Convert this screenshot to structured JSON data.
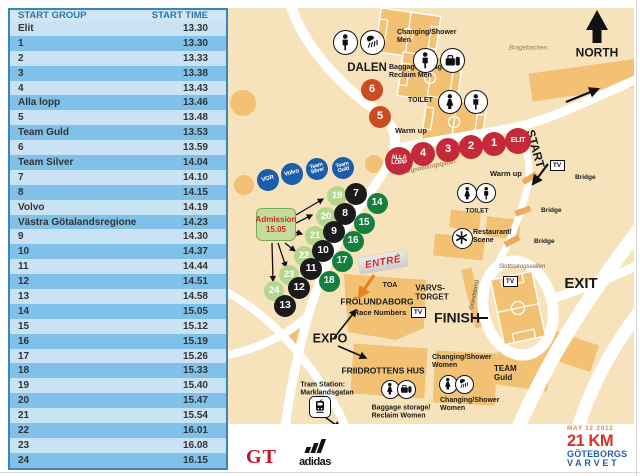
{
  "colors": {
    "map_bg": "#f7e3bb",
    "building": "#f2c173",
    "road": "#ffffff",
    "red": "#c42a3a",
    "orangered": "#cc4b20",
    "blue": "#1a5da8",
    "black_badge": "#1b1b1b",
    "dark_green": "#15803d",
    "light_green": "#b5d78d",
    "table_border": "#3a86bb",
    "row_light": "#c9e3f4",
    "row_dark": "#7fc1e8",
    "header_bg": "#d2e6f3",
    "header_text": "#2d76ab",
    "cell_text": "#333333",
    "admission_bg": "#c3dc9b",
    "admission_border": "#76ab53",
    "admission_text": "#d22b2b",
    "entre_text": "#d42b2b",
    "street_text": "#8a6a40",
    "logo_date": "#d98a3f",
    "logo_distance": "#d63226",
    "logo_name": "#2160a8",
    "gt_red": "#cc1126"
  },
  "table": {
    "headers": [
      "START GROUP",
      "START TIME"
    ],
    "rows": [
      [
        "Elit",
        "13.30"
      ],
      [
        "1",
        "13.30"
      ],
      [
        "2",
        "13.33"
      ],
      [
        "3",
        "13.38"
      ],
      [
        "4",
        "13.43"
      ],
      [
        "Alla lopp",
        "13.46"
      ],
      [
        "5",
        "13.48"
      ],
      [
        "Team Guld",
        "13.53"
      ],
      [
        "6",
        "13.59"
      ],
      [
        "Team Silver",
        "14.04"
      ],
      [
        "7",
        "14.10"
      ],
      [
        "8",
        "14.15"
      ],
      [
        "Volvo",
        "14.19"
      ],
      [
        "Västra Götalandsregionen",
        "14.23"
      ],
      [
        "9",
        "14.30"
      ],
      [
        "10",
        "14.37"
      ],
      [
        "11",
        "14.44"
      ],
      [
        "12",
        "14.51"
      ],
      [
        "13",
        "14.58"
      ],
      [
        "14",
        "15.05"
      ],
      [
        "15",
        "15.12"
      ],
      [
        "16",
        "15.19"
      ],
      [
        "17",
        "15.26"
      ],
      [
        "18",
        "15.33"
      ],
      [
        "19",
        "15.40"
      ],
      [
        "20",
        "15.47"
      ],
      [
        "21",
        "15.54"
      ],
      [
        "22",
        "16.01"
      ],
      [
        "23",
        "16.08"
      ],
      [
        "24",
        "16.15"
      ]
    ]
  },
  "map": {
    "tv_label": "TV",
    "entre": {
      "text": "ENTRÉ"
    },
    "admission": {
      "line1": "Admission",
      "line2": "15.05"
    },
    "labels": [
      {
        "name": "label-changing-shower-men",
        "text": "Changing/Shower\nMen",
        "x": 169,
        "y": 21,
        "size": 7,
        "align": "l"
      },
      {
        "name": "label-dalen",
        "text": "DALEN",
        "x": 139,
        "y": 60,
        "size": 11.5,
        "align": "c"
      },
      {
        "name": "label-baggage-men",
        "text": "Baggage storage/\nReclaim  Men",
        "x": 161,
        "y": 56,
        "size": 7,
        "align": "l"
      },
      {
        "name": "label-toilet-top",
        "text": "TOILET",
        "x": 180,
        "y": 89,
        "size": 7,
        "align": "l"
      },
      {
        "name": "label-warm-up-1",
        "text": "Warm up",
        "x": 167,
        "y": 119,
        "size": 7.5,
        "align": "l"
      },
      {
        "name": "label-warm-up-2",
        "text": "Warm up",
        "x": 262,
        "y": 162,
        "size": 7.5,
        "align": "l"
      },
      {
        "name": "label-bragebacken",
        "text": "Bragebacken",
        "x": 300,
        "y": 40,
        "size": 6.5,
        "align": "c",
        "italic": true,
        "weight": "normal",
        "color": "#9a7b52"
      },
      {
        "name": "label-north",
        "text": "NORTH",
        "x": 369,
        "y": 45,
        "size": 12,
        "align": "c"
      },
      {
        "name": "label-margreteborgsgatan",
        "text": "Margreteborgsgatan",
        "x": 200,
        "y": 160,
        "size": 6.2,
        "align": "c",
        "rotate": -12,
        "weight": "normal",
        "color": "#8a6a40"
      },
      {
        "name": "label-start",
        "text": "START",
        "x": 307,
        "y": 141,
        "size": 12,
        "align": "c",
        "rotate": 74
      },
      {
        "name": "label-bridge-1",
        "text": "Bridge",
        "x": 347,
        "y": 166,
        "size": 6.5,
        "align": "l"
      },
      {
        "name": "label-bridge-2",
        "text": "Bridge",
        "x": 313,
        "y": 199,
        "size": 6.5,
        "align": "l"
      },
      {
        "name": "label-bridge-3",
        "text": "Bridge",
        "x": 306,
        "y": 230,
        "size": 6.5,
        "align": "l"
      },
      {
        "name": "label-toilet-mid",
        "text": "TOILET",
        "x": 249,
        "y": 203,
        "size": 6.5,
        "align": "c"
      },
      {
        "name": "label-restaurant-scene",
        "text": "Restaurant/\nScene",
        "x": 245,
        "y": 221,
        "size": 7,
        "align": "l"
      },
      {
        "name": "label-slottsskogsvallen",
        "text": "Slottsskogsvallen",
        "x": 294,
        "y": 259,
        "size": 6,
        "align": "c",
        "italic": true,
        "weight": "normal",
        "color": "#6b5a3a"
      },
      {
        "name": "label-exit",
        "text": "EXIT",
        "x": 353,
        "y": 276,
        "size": 15,
        "align": "c"
      },
      {
        "name": "label-grandstand",
        "text": "Grandstand",
        "x": 247,
        "y": 287,
        "size": 5.8,
        "align": "c",
        "rotate": -78,
        "weight": "normal",
        "color": "#444444"
      },
      {
        "name": "label-varvstorget",
        "text": "VARVS-\nTORGET",
        "x": 204,
        "y": 285,
        "size": 8,
        "align": "c"
      },
      {
        "name": "label-finish",
        "text": "FINISH",
        "x": 229,
        "y": 310,
        "size": 14,
        "align": "c"
      },
      {
        "name": "label-toa",
        "text": "TOA",
        "x": 162,
        "y": 278,
        "size": 7,
        "align": "c"
      },
      {
        "name": "label-frolundaborg",
        "text": "FRÖLUNDABORG",
        "x": 149,
        "y": 294,
        "size": 8.5,
        "align": "c"
      },
      {
        "name": "label-race-numbers",
        "text": "Race Numbers",
        "x": 152,
        "y": 305,
        "size": 7.5,
        "align": "c"
      },
      {
        "name": "label-expo",
        "text": "EXPO",
        "x": 102,
        "y": 331,
        "size": 12.5,
        "align": "c"
      },
      {
        "name": "label-friidrottens-hus",
        "text": "FRIIDROTTENS HUS",
        "x": 155,
        "y": 363,
        "size": 8.5,
        "align": "c"
      },
      {
        "name": "label-baggage-women",
        "text": "Baggage storage/\nReclaim  Women",
        "x": 173,
        "y": 404,
        "size": 7,
        "align": "c"
      },
      {
        "name": "label-changing-women-1",
        "text": "Changing/Shower\nWomen",
        "x": 204,
        "y": 346,
        "size": 7,
        "align": "l"
      },
      {
        "name": "label-changing-women-2",
        "text": "Changing/Shower\nWomen",
        "x": 212,
        "y": 389,
        "size": 7,
        "align": "l"
      },
      {
        "name": "label-team-guld",
        "text": "TEAM\nGuld",
        "x": 266,
        "y": 357,
        "size": 8,
        "align": "l"
      },
      {
        "name": "label-tram-station",
        "text": "Tram Station:\nMarklandsgatan",
        "x": 99,
        "y": 381,
        "size": 7,
        "align": "c"
      }
    ],
    "badges": [
      {
        "name": "badge-6",
        "label": "6",
        "x": 144,
        "y": 82,
        "r": 11,
        "color": "orangered",
        "size": 11
      },
      {
        "name": "badge-5",
        "label": "5",
        "x": 152,
        "y": 109,
        "r": 11,
        "color": "orangered",
        "size": 11
      },
      {
        "name": "badge-alla-lopp",
        "label": "ALLA\nLOPP",
        "x": 171,
        "y": 153,
        "r": 14,
        "color": "red",
        "size": 6
      },
      {
        "name": "badge-4",
        "label": "4",
        "x": 195,
        "y": 146,
        "r": 12,
        "color": "red",
        "size": 11
      },
      {
        "name": "badge-3",
        "label": "3",
        "x": 220,
        "y": 142,
        "r": 12,
        "color": "red",
        "size": 11
      },
      {
        "name": "badge-2",
        "label": "2",
        "x": 243,
        "y": 139,
        "r": 12,
        "color": "red",
        "size": 11
      },
      {
        "name": "badge-1",
        "label": "1",
        "x": 266,
        "y": 136,
        "r": 12,
        "color": "red",
        "size": 11
      },
      {
        "name": "badge-elit",
        "label": "ELIT",
        "x": 290,
        "y": 133,
        "r": 13,
        "color": "red",
        "size": 7
      },
      {
        "name": "badge-vgr",
        "label": "VGR",
        "x": 40,
        "y": 172,
        "r": 11,
        "color": "blue",
        "size": 6,
        "rotate": -15
      },
      {
        "name": "badge-volvo",
        "label": "Volvo",
        "x": 64,
        "y": 166,
        "r": 11,
        "color": "blue",
        "size": 6,
        "rotate": -15
      },
      {
        "name": "badge-team-silver",
        "label": "Team\nSilver",
        "x": 89,
        "y": 161,
        "r": 11,
        "color": "blue",
        "size": 5.5,
        "rotate": -15
      },
      {
        "name": "badge-team-guld",
        "label": "Team\nGuld",
        "x": 115,
        "y": 160,
        "r": 11,
        "color": "blue",
        "size": 5.5,
        "rotate": -15
      },
      {
        "name": "badge-19",
        "label": "19",
        "x": 109,
        "y": 188,
        "r": 10,
        "color": "light_green",
        "size": 9.5
      },
      {
        "name": "badge-7",
        "label": "7",
        "x": 128,
        "y": 186,
        "r": 11,
        "color": "black_badge",
        "size": 10.5
      },
      {
        "name": "badge-14",
        "label": "14",
        "x": 149,
        "y": 195,
        "r": 10.5,
        "color": "dark_green",
        "size": 10
      },
      {
        "name": "badge-20",
        "label": "20",
        "x": 98,
        "y": 209,
        "r": 10,
        "color": "light_green",
        "size": 9.5
      },
      {
        "name": "badge-8",
        "label": "8",
        "x": 117,
        "y": 206,
        "r": 11,
        "color": "black_badge",
        "size": 10.5
      },
      {
        "name": "badge-15",
        "label": "15",
        "x": 136,
        "y": 215,
        "r": 10.5,
        "color": "dark_green",
        "size": 10
      },
      {
        "name": "badge-21",
        "label": "21",
        "x": 87,
        "y": 228,
        "r": 10,
        "color": "light_green",
        "size": 9.5
      },
      {
        "name": "badge-9",
        "label": "9",
        "x": 106,
        "y": 224,
        "r": 11,
        "color": "black_badge",
        "size": 10.5
      },
      {
        "name": "badge-16",
        "label": "16",
        "x": 125,
        "y": 233,
        "r": 10.5,
        "color": "dark_green",
        "size": 10
      },
      {
        "name": "badge-22",
        "label": "22",
        "x": 76,
        "y": 248,
        "r": 10,
        "color": "light_green",
        "size": 9.5
      },
      {
        "name": "badge-10",
        "label": "10",
        "x": 95,
        "y": 243,
        "r": 11,
        "color": "black_badge",
        "size": 10.5
      },
      {
        "name": "badge-17",
        "label": "17",
        "x": 114,
        "y": 253,
        "r": 10.5,
        "color": "dark_green",
        "size": 10
      },
      {
        "name": "badge-23",
        "label": "23",
        "x": 61,
        "y": 267,
        "r": 10,
        "color": "light_green",
        "size": 9.5
      },
      {
        "name": "badge-11",
        "label": "11",
        "x": 83,
        "y": 261,
        "r": 11,
        "color": "black_badge",
        "size": 10.5
      },
      {
        "name": "badge-18",
        "label": "18",
        "x": 101,
        "y": 273,
        "r": 10.5,
        "color": "dark_green",
        "size": 10
      },
      {
        "name": "badge-24",
        "label": "24",
        "x": 46,
        "y": 283,
        "r": 10,
        "color": "light_green",
        "size": 9.5
      },
      {
        "name": "badge-12",
        "label": "12",
        "x": 71,
        "y": 280,
        "r": 11,
        "color": "black_badge",
        "size": 10.5
      },
      {
        "name": "badge-13",
        "label": "13",
        "x": 57,
        "y": 298,
        "r": 11,
        "color": "black_badge",
        "size": 10.5
      }
    ],
    "icons": [
      {
        "name": "men-icon",
        "glyph": "man",
        "x": 117,
        "y": 34,
        "d": 25
      },
      {
        "name": "shower-icon-men",
        "glyph": "shower",
        "x": 144,
        "y": 34,
        "d": 25
      },
      {
        "name": "men-baggage-person-icon",
        "glyph": "man",
        "x": 197,
        "y": 52,
        "d": 25
      },
      {
        "name": "baggage-icon-men",
        "glyph": "bag",
        "x": 224,
        "y": 52,
        "d": 25
      },
      {
        "name": "toilet-women-icon-top",
        "glyph": "woman",
        "x": 222,
        "y": 94,
        "d": 24
      },
      {
        "name": "toilet-men-icon-top",
        "glyph": "man",
        "x": 248,
        "y": 94,
        "d": 24
      },
      {
        "name": "toilet-women-icon-mid",
        "glyph": "woman",
        "x": 239,
        "y": 185,
        "d": 20
      },
      {
        "name": "toilet-men-icon-mid",
        "glyph": "man",
        "x": 258,
        "y": 185,
        "d": 20
      },
      {
        "name": "restaurant-icon",
        "glyph": "restaurant",
        "x": 234,
        "y": 230,
        "d": 21
      },
      {
        "name": "women-baggage-person-icon",
        "glyph": "woman",
        "x": 162,
        "y": 381,
        "d": 19
      },
      {
        "name": "baggage-icon-women",
        "glyph": "bag",
        "x": 178,
        "y": 381,
        "d": 19
      },
      {
        "name": "women-changing-icon",
        "glyph": "woman",
        "x": 220,
        "y": 376,
        "d": 19
      },
      {
        "name": "shower-icon-women",
        "glyph": "shower",
        "x": 236,
        "y": 376,
        "d": 19
      },
      {
        "name": "tram-icon",
        "glyph": "tram",
        "x": 92,
        "y": 399,
        "d": 22,
        "square": true
      }
    ],
    "tv_boxes": [
      {
        "x": 329,
        "y": 157
      },
      {
        "x": 282,
        "y": 273
      },
      {
        "x": 190,
        "y": 304
      }
    ]
  },
  "footer": {
    "gt": "GT",
    "adidas": "adidas",
    "event_date": "MAY 12 2012",
    "event_distance": "21 KM",
    "event_name1": "GÖTEBORGS",
    "event_name2": "VARVET"
  }
}
